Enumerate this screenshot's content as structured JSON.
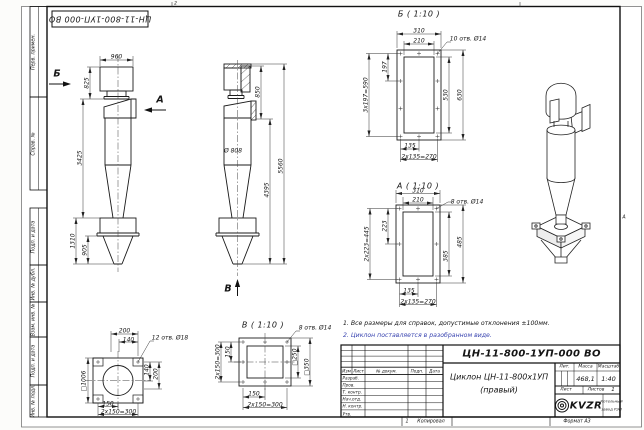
{
  "frame": {
    "stamp_top": "ЦН-11-800-1УП-000 ВО",
    "margin_labels": [
      "Перв. примен.",
      "Справ. №",
      "Подп. и дата",
      "Инв. № дубл.",
      "Взам. инв. №",
      "Подп. и дата",
      "Инв. № подл."
    ],
    "zone_top": "2",
    "zone_right": "А"
  },
  "views": {
    "front": {
      "arrow_b": "Б",
      "arrow_a": "А",
      "dim_width": "960",
      "dim_825": "825",
      "dim_3425": "3425",
      "dim_1310": "1310",
      "dim_905": "905"
    },
    "side": {
      "arrow_v": "В",
      "dim_850": "850",
      "dim_4395": "4395",
      "dim_5560": "5560",
      "dim_diam": "Ø 808"
    },
    "detail_b": {
      "title": "Б ( 1:10 )",
      "holes": "10 отв. Ø14",
      "d310": "310",
      "d210": "210",
      "d197": "197",
      "d197t": "3х197=590",
      "d530": "530",
      "d630": "630",
      "d135": "135",
      "d135t": "2х135=270"
    },
    "detail_a": {
      "title": "А ( 1:10 )",
      "holes": "8 отв. Ø14",
      "d310": "310",
      "d210": "210",
      "d223": "223",
      "d223t": "2х223=445",
      "d385": "385",
      "d485": "485",
      "d135": "135",
      "d135t": "2х135=270"
    },
    "detail_v": {
      "title": "В ( 1:10 )",
      "holes": "8 отв. Ø14",
      "d150l": "150",
      "d150lt": "2х150=300",
      "d250": "□250",
      "d350": "□350",
      "d150b": "150",
      "d150bt": "2х150=300"
    },
    "bottom_view": {
      "holes": "12 отв. Ø18",
      "d200t": "200",
      "d140t": "140",
      "d140r": "140",
      "d200r": "200",
      "dsq": "□1006",
      "d150": "150",
      "d150t": "2х150=300"
    }
  },
  "notes": {
    "line1": "1. Все размеры для справок, допустимые отклонения ±100мм.",
    "line2": "2. Циклон поставляется в разобранном виде."
  },
  "title_block": {
    "doc_number": "ЦН-11-800-1УП-000 ВО",
    "name1": "Циклон ЦН-11-800х1УП",
    "name2": "(правый)",
    "lit": "Лит.",
    "mass_label": "Масса",
    "scale_label": "Масштаб",
    "mass": "468,1",
    "scale": "1:40",
    "sheet": "Лист",
    "sheets": "Листов",
    "sheets_n": "1",
    "cols": [
      "Изм",
      "Лист",
      "№ докум.",
      "Подп.",
      "Дата"
    ],
    "rows": [
      "Разраб.",
      "Пров.",
      "Т. контр.",
      "Нач.отд.",
      "Н. контр.",
      "Утв."
    ],
    "logo": "KVZR",
    "company1": "Котельный",
    "company2": "завод РЭП",
    "copy": "Копировал",
    "format": "Формат А3",
    "znum": "1"
  }
}
